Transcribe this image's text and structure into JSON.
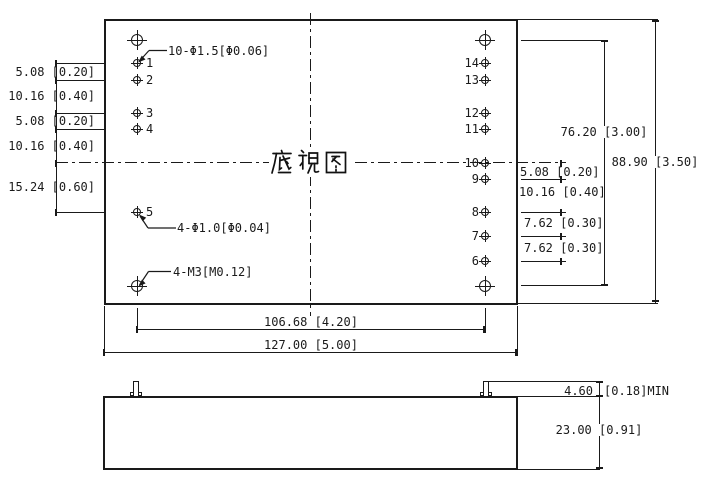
{
  "colors": {
    "background": "#ffffff",
    "line": "#1a1a1a"
  },
  "plan_view": {
    "title": "底视图",
    "annotations": {
      "pin_holes": "10-Φ1.5[Φ0.06]",
      "small_pins": "4-Φ1.0[Φ0.04]",
      "mounting_screws": "4-M3[M0.12]"
    },
    "left_pin_labels": [
      "1",
      "2",
      "3",
      "4",
      "5"
    ],
    "right_pin_labels": [
      "14",
      "13",
      "12",
      "11",
      "10",
      "9",
      "8",
      "7",
      "6"
    ],
    "left_dims": [
      "5.08 [0.20]",
      "10.16 [0.40]",
      "5.08 [0.20]",
      "10.16 [0.40]",
      "15.24 [0.60]"
    ],
    "right_pin_dims": [
      "5.08 [0.20]",
      "10.16 [0.40]",
      "7.62 [0.30]",
      "7.62 [0.30]"
    ],
    "hole_span_dim": "76.20 [3.00]",
    "case_length_dim": "88.90 [3.50]",
    "pin_span_dim": "106.68 [4.20]",
    "case_width_dim": "127.00 [5.00]"
  },
  "side_view": {
    "pin_standoff_dim": "4.60",
    "pin_standoff_suffix": "[0.18]MIN",
    "case_height_dim": "23.00 [0.91]"
  }
}
